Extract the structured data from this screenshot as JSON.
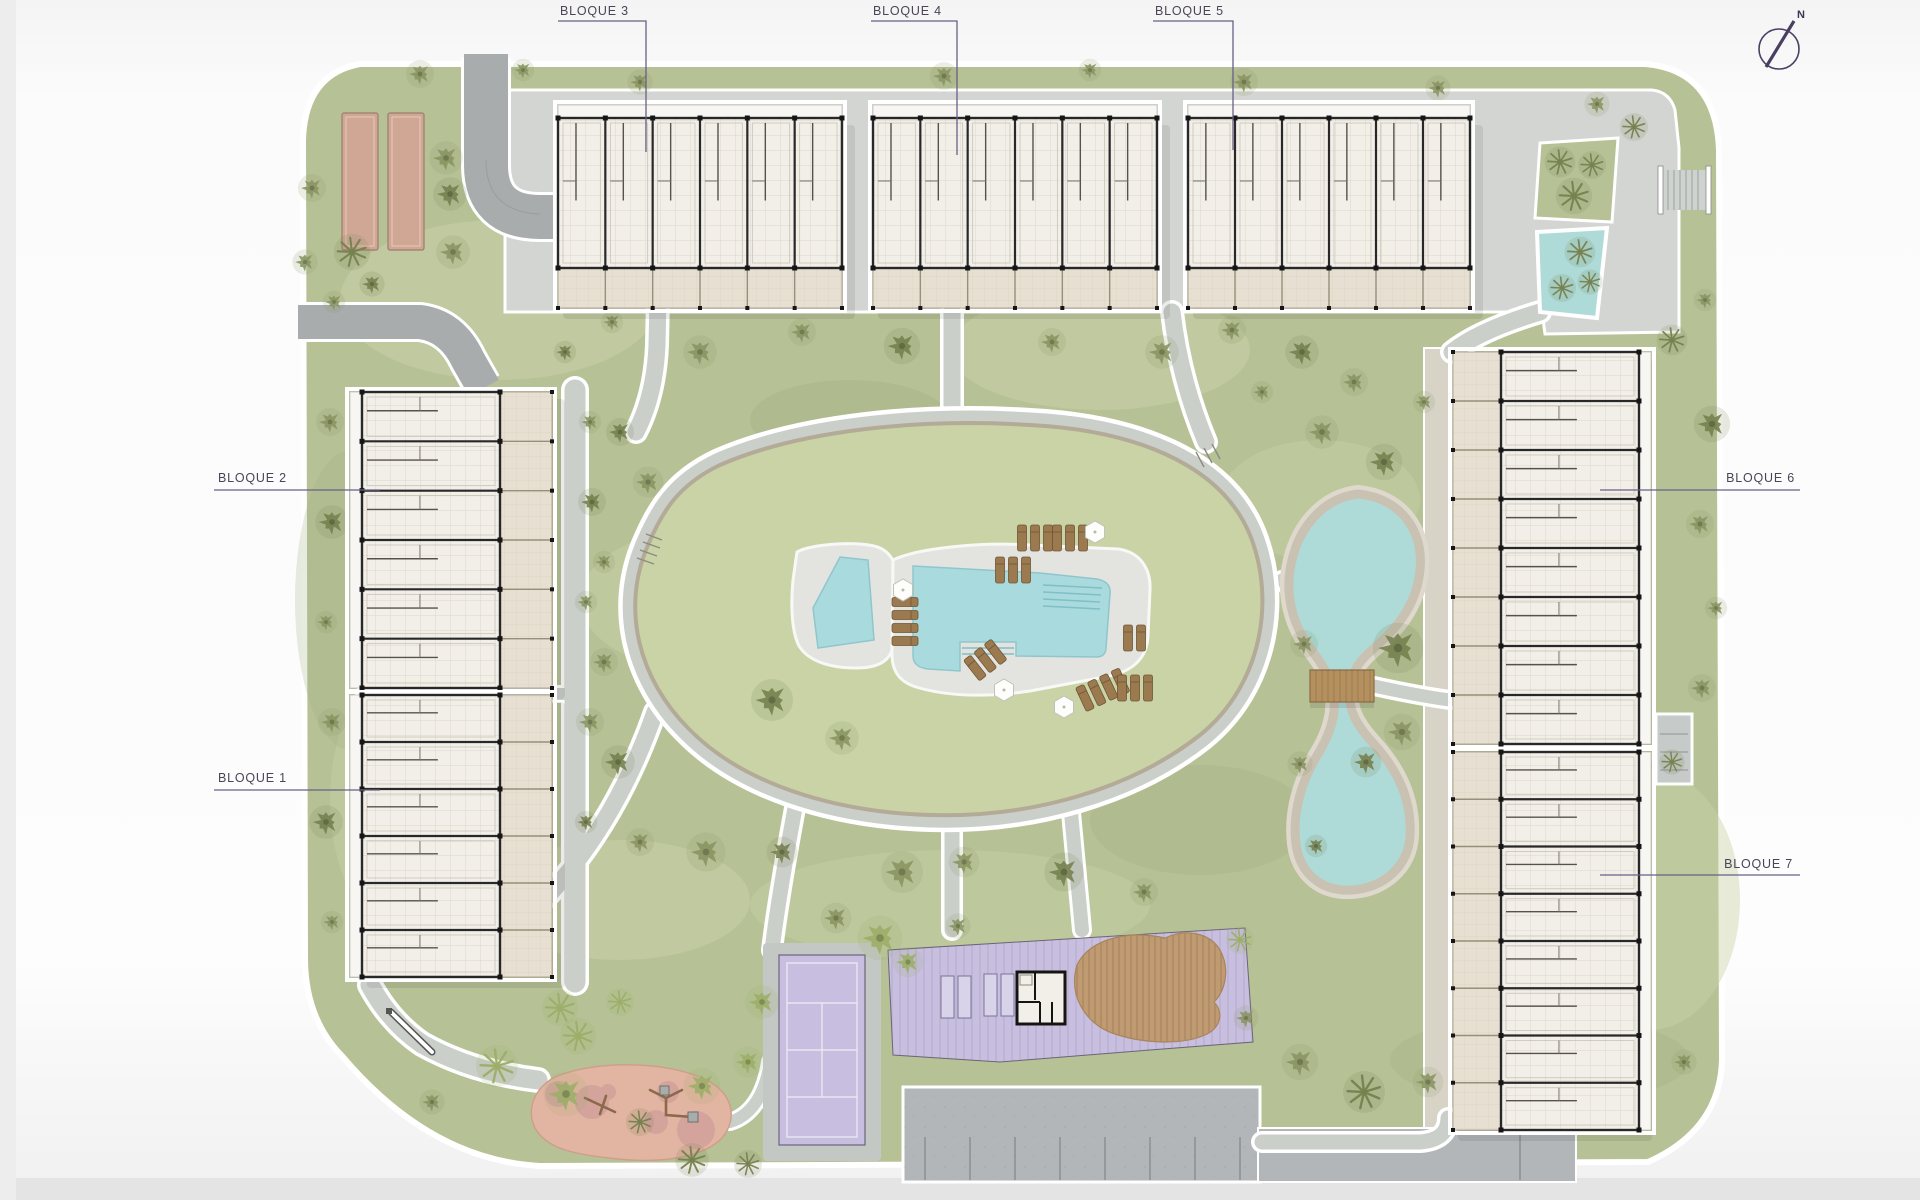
{
  "labels": {
    "blocks": [
      {
        "id": "bloque-3",
        "text": "BLOQUE 3"
      },
      {
        "id": "bloque-4",
        "text": "BLOQUE 4"
      },
      {
        "id": "bloque-5",
        "text": "BLOQUE 5"
      },
      {
        "id": "bloque-2",
        "text": "BLOQUE 2"
      },
      {
        "id": "bloque-1",
        "text": "BLOQUE 1"
      },
      {
        "id": "bloque-6",
        "text": "BLOQUE 6"
      },
      {
        "id": "bloque-7",
        "text": "BLOQUE 7"
      }
    ],
    "north": "N"
  },
  "palette": {
    "grass": "#b6c196",
    "grass_light": "#c9d2a8",
    "grass_dark": "#a4b083",
    "mound": "#c9d3a6",
    "path": "#cbcfca",
    "road": "#a8acad",
    "gravel": "#d8d3c7",
    "plaza": "#d2d5d1",
    "water_pool": "#a9dade",
    "water_lake": "#aedbd8",
    "pool_deck": "#e3e4e0",
    "building_fill": "#f2efe9",
    "building_wall": "#282828",
    "terrace": "#e6dfd2",
    "purple_zone": "#c8bfe0",
    "wood_deck": "#c09a71",
    "bridge_wood": "#b5905f",
    "playground": "#e2b4a2",
    "playground_spot": "#c59497",
    "lounger": "#9b7a50",
    "lounger_edge": "#6f5536",
    "petanque": "#d0a795",
    "parking": "#b2b6b8",
    "stone_rim": "#b3ab97",
    "label_text": "#4b4458",
    "leader_line": "#6a5f86",
    "tree_shades": [
      "#76814f",
      "#8a9562",
      "#67744a",
      "#9cae68"
    ]
  }
}
